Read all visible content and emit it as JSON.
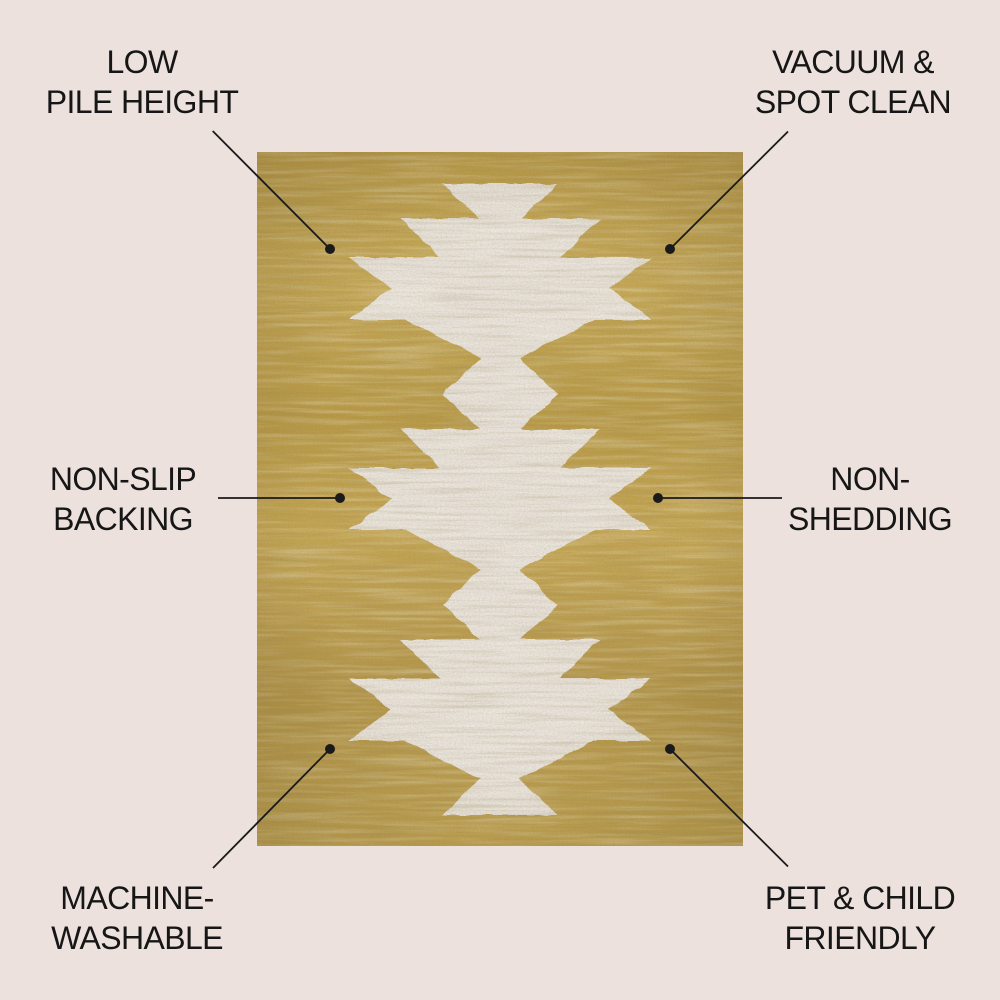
{
  "colors": {
    "background": "#ece1dc",
    "rug_gold": "#bfa04e",
    "motif_white": "#e9e3dc",
    "callout": "#1a1a1a",
    "text": "#161616"
  },
  "features": [
    {
      "placement": "top-left",
      "line1": "LOW",
      "line2": "PILE HEIGHT"
    },
    {
      "placement": "top-right",
      "line1": "VACUUM &",
      "line2": "SPOT CLEAN"
    },
    {
      "placement": "middle-left",
      "line1": "NON-SLIP",
      "line2": "BACKING"
    },
    {
      "placement": "middle-right",
      "line1": "NON-",
      "line2": "SHEDDING"
    },
    {
      "placement": "bottom-left",
      "line1": "MACHINE-",
      "line2": "WASHABLE"
    },
    {
      "placement": "bottom-right",
      "line1": "PET & CHILD",
      "line2": "FRIENDLY"
    }
  ]
}
